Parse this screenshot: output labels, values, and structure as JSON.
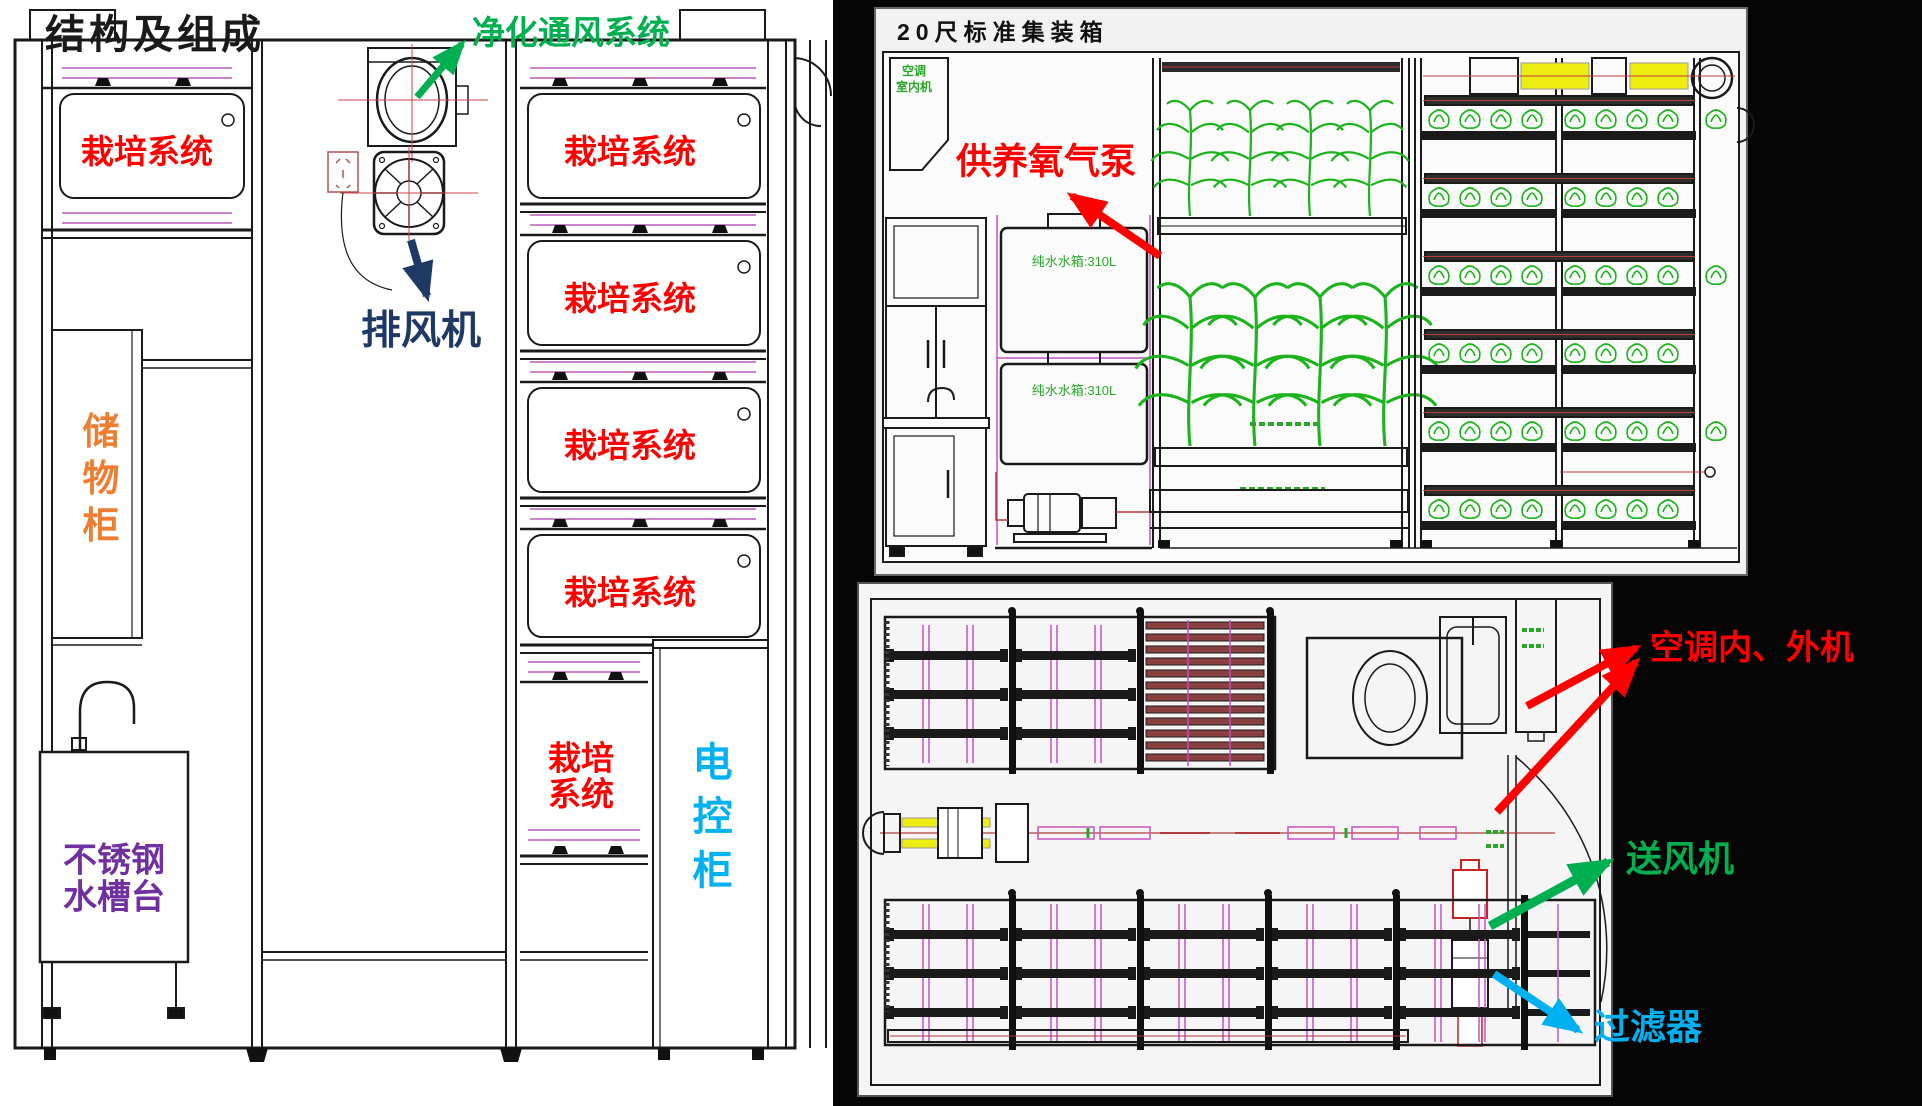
{
  "colors": {
    "annotation_red": "#FF0000",
    "annotation_green": "#00B050",
    "annotation_navy": "#1F3864",
    "annotation_orange": "#ED7D31",
    "annotation_purple": "#7030A0",
    "annotation_cyan": "#00B0F0",
    "cad_line": "#1a1a1a",
    "rail_magenta": "#C353C3",
    "plant_green": "#1DB31D",
    "highlight_yellow": "#EDED12"
  },
  "left_panel": {
    "title": "结构及组成",
    "purification_vent_label": "净化通风系统",
    "cultivation_label": "栽培系统",
    "cultivation_label_stacked": "栽培\n系统",
    "exhaust_fan_label": "排风机",
    "storage_cabinet_label": "储物柜",
    "sink_label": "不锈钢\n水槽台",
    "control_cabinet_label": "电控柜"
  },
  "top_right_panel": {
    "title": "20尺标准集装箱",
    "oxygen_pump_label": "供养氧气泵",
    "ac_indoor_label": "空调\n室内机",
    "water_tank_label_1": "纯水水箱:310L",
    "water_tank_label_2": "纯水水箱:310L"
  },
  "bottom_right_panel": {
    "ac_units_label": "空调内、外机",
    "supply_fan_label": "送风机",
    "filter_label": "过滤器"
  }
}
